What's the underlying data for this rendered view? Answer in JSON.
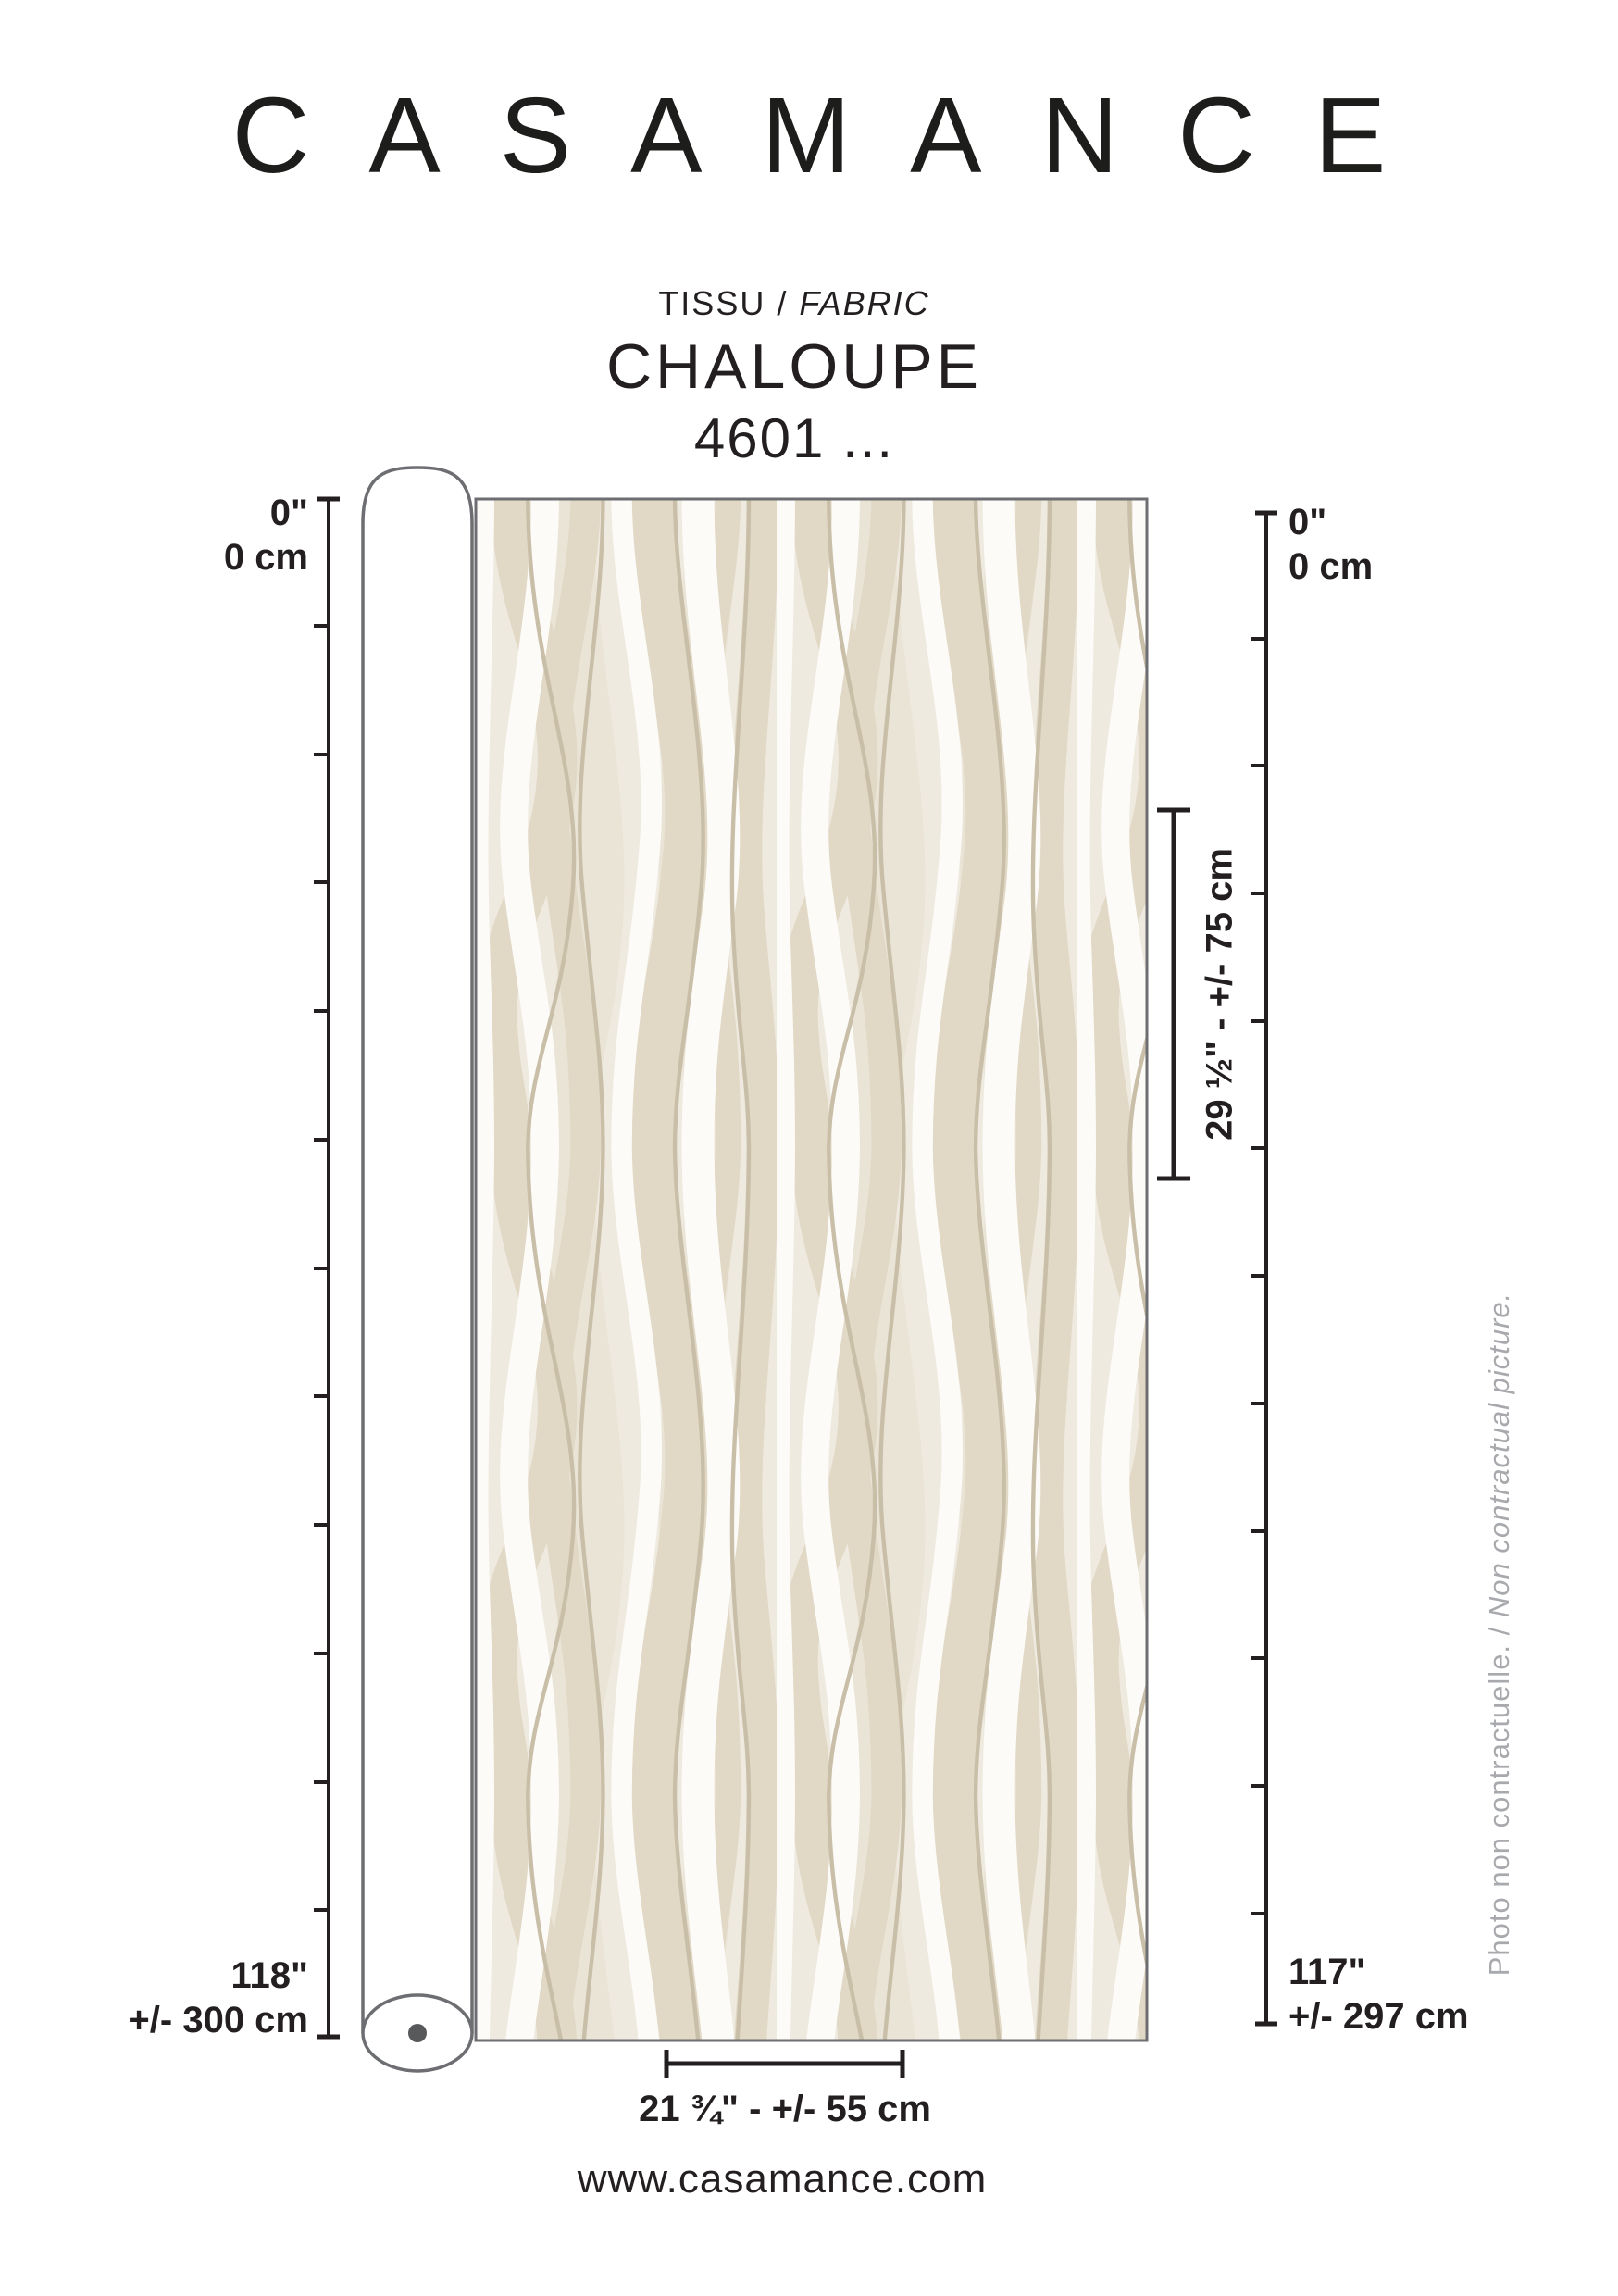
{
  "colors": {
    "text": "#231f20",
    "outline_grey": "#6d6e71",
    "roll_core_dot": "#58595b",
    "side_note_grey": "#a7a9ac",
    "fabric_background": "#efeae0",
    "fabric_ribbon_beige": "#e1d8c5",
    "fabric_ribbon_soft": "#eae4d6",
    "fabric_ribbon_white": "#fcfbf7",
    "fabric_line_tan": "#c9bea7"
  },
  "header": {
    "logo": "CASAMANCE",
    "type_fr": "TISSU",
    "type_sep": " / ",
    "type_en": "FABRIC",
    "product_name": "CHALOUPE",
    "reference": "4601 ..."
  },
  "left_ruler": {
    "zero_in": "0\"",
    "zero_cm": "0 cm",
    "total_in": "118\"",
    "total_cm": "+/- 300 cm"
  },
  "right_ruler": {
    "zero_in": "0\"",
    "zero_cm": "0 cm",
    "total_in": "117\"",
    "total_cm": "+/- 297 cm"
  },
  "measures": {
    "vertical_repeat": "29 ½\" - +/- 75 cm",
    "width": "21 ¾\" - +/- 55 cm"
  },
  "side_note": {
    "fr": "Photo non contractuelle.",
    "sep": " / ",
    "en": "Non contractual picture."
  },
  "footer": {
    "website": "www.casamance.com"
  }
}
